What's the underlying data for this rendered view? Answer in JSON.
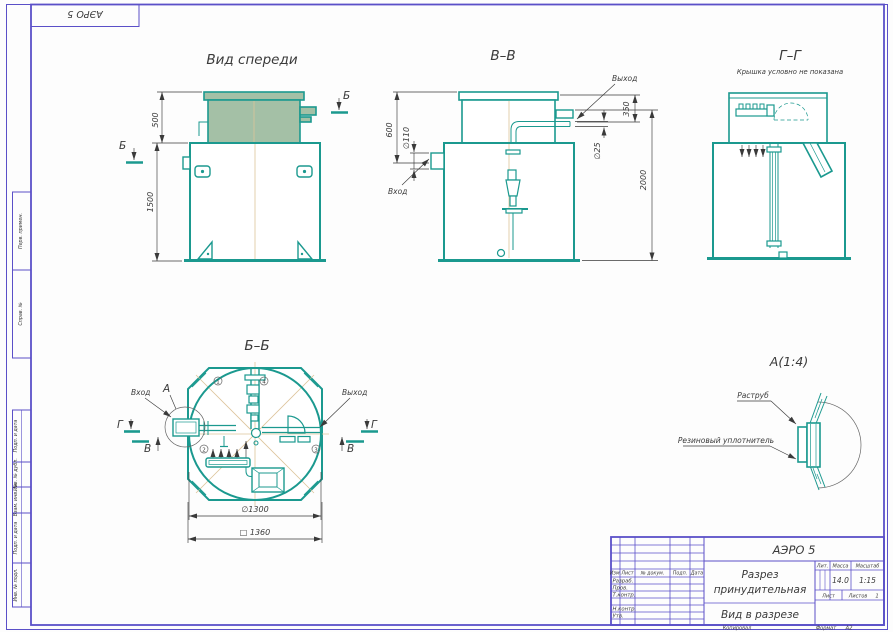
{
  "sheet": {
    "top_stamp": "АЭРО 5",
    "margin_boxes": [
      "Перв. примен.",
      "Справ. №",
      "Подп. и дата",
      "Инв. № дубл.",
      "Взам. инв. №",
      "Подп. и дата",
      "Инв. № подл."
    ],
    "kopiroval": "Копировал",
    "format_label": "Формат",
    "format_value": "А2"
  },
  "views": {
    "front": {
      "title": "Вид спереди",
      "dim_500": "500",
      "dim_1500": "1500",
      "mark_b": "Б"
    },
    "vv": {
      "title": "В–В",
      "dim_600": "600",
      "dim_d110": "∅110",
      "dim_350": "350",
      "dim_d25": "∅25",
      "dim_2000": "2000",
      "inlet": "Вход",
      "outlet": "Выход"
    },
    "gg": {
      "title": "Г–Г",
      "note": "Крышка условно не показана"
    },
    "bb": {
      "title": "Б–Б",
      "inlet": "Вход",
      "outlet": "Выход",
      "mark_a": "А",
      "mark_v": "В",
      "mark_g": "Г",
      "dim_d1300": "∅1300",
      "dim_sq1360": "□ 1360",
      "callouts": {
        "c1": "1",
        "c2": "4",
        "c3": "2",
        "c4": "3"
      }
    },
    "detail_a": {
      "title": "А(1:4)",
      "label_socket": "Раструб",
      "label_seal": "Резиновый уплотнитель"
    }
  },
  "title_block": {
    "doc_name": "АЭРО 5",
    "name_line1": "Разрез",
    "name_line2": "принудительная",
    "view_name": "Вид в разрезе",
    "col_izm": "Изм.",
    "col_list": "Лист",
    "col_doc": "№ докум.",
    "col_podp": "Подп.",
    "col_data": "Дата",
    "row_razrab": "Разраб.",
    "row_prov": "Пров.",
    "row_tkontr": "Т.контр.",
    "row_nkontr": "Н.контр.",
    "row_utv": "Утв.",
    "lit_label": "Лит.",
    "massa_label": "Масса",
    "masshtab_label": "Масштаб",
    "massa_value": "14.0",
    "masshtab_value": "1:15",
    "list_label": "Лист",
    "listov_label": "Листов",
    "listov_value": "1"
  },
  "colors": {
    "line": "#1b998f",
    "frame": "#5b50c8",
    "lid": "#a4c0a6",
    "ink": "#3a3a3a",
    "centerline": "#dcc49a"
  }
}
